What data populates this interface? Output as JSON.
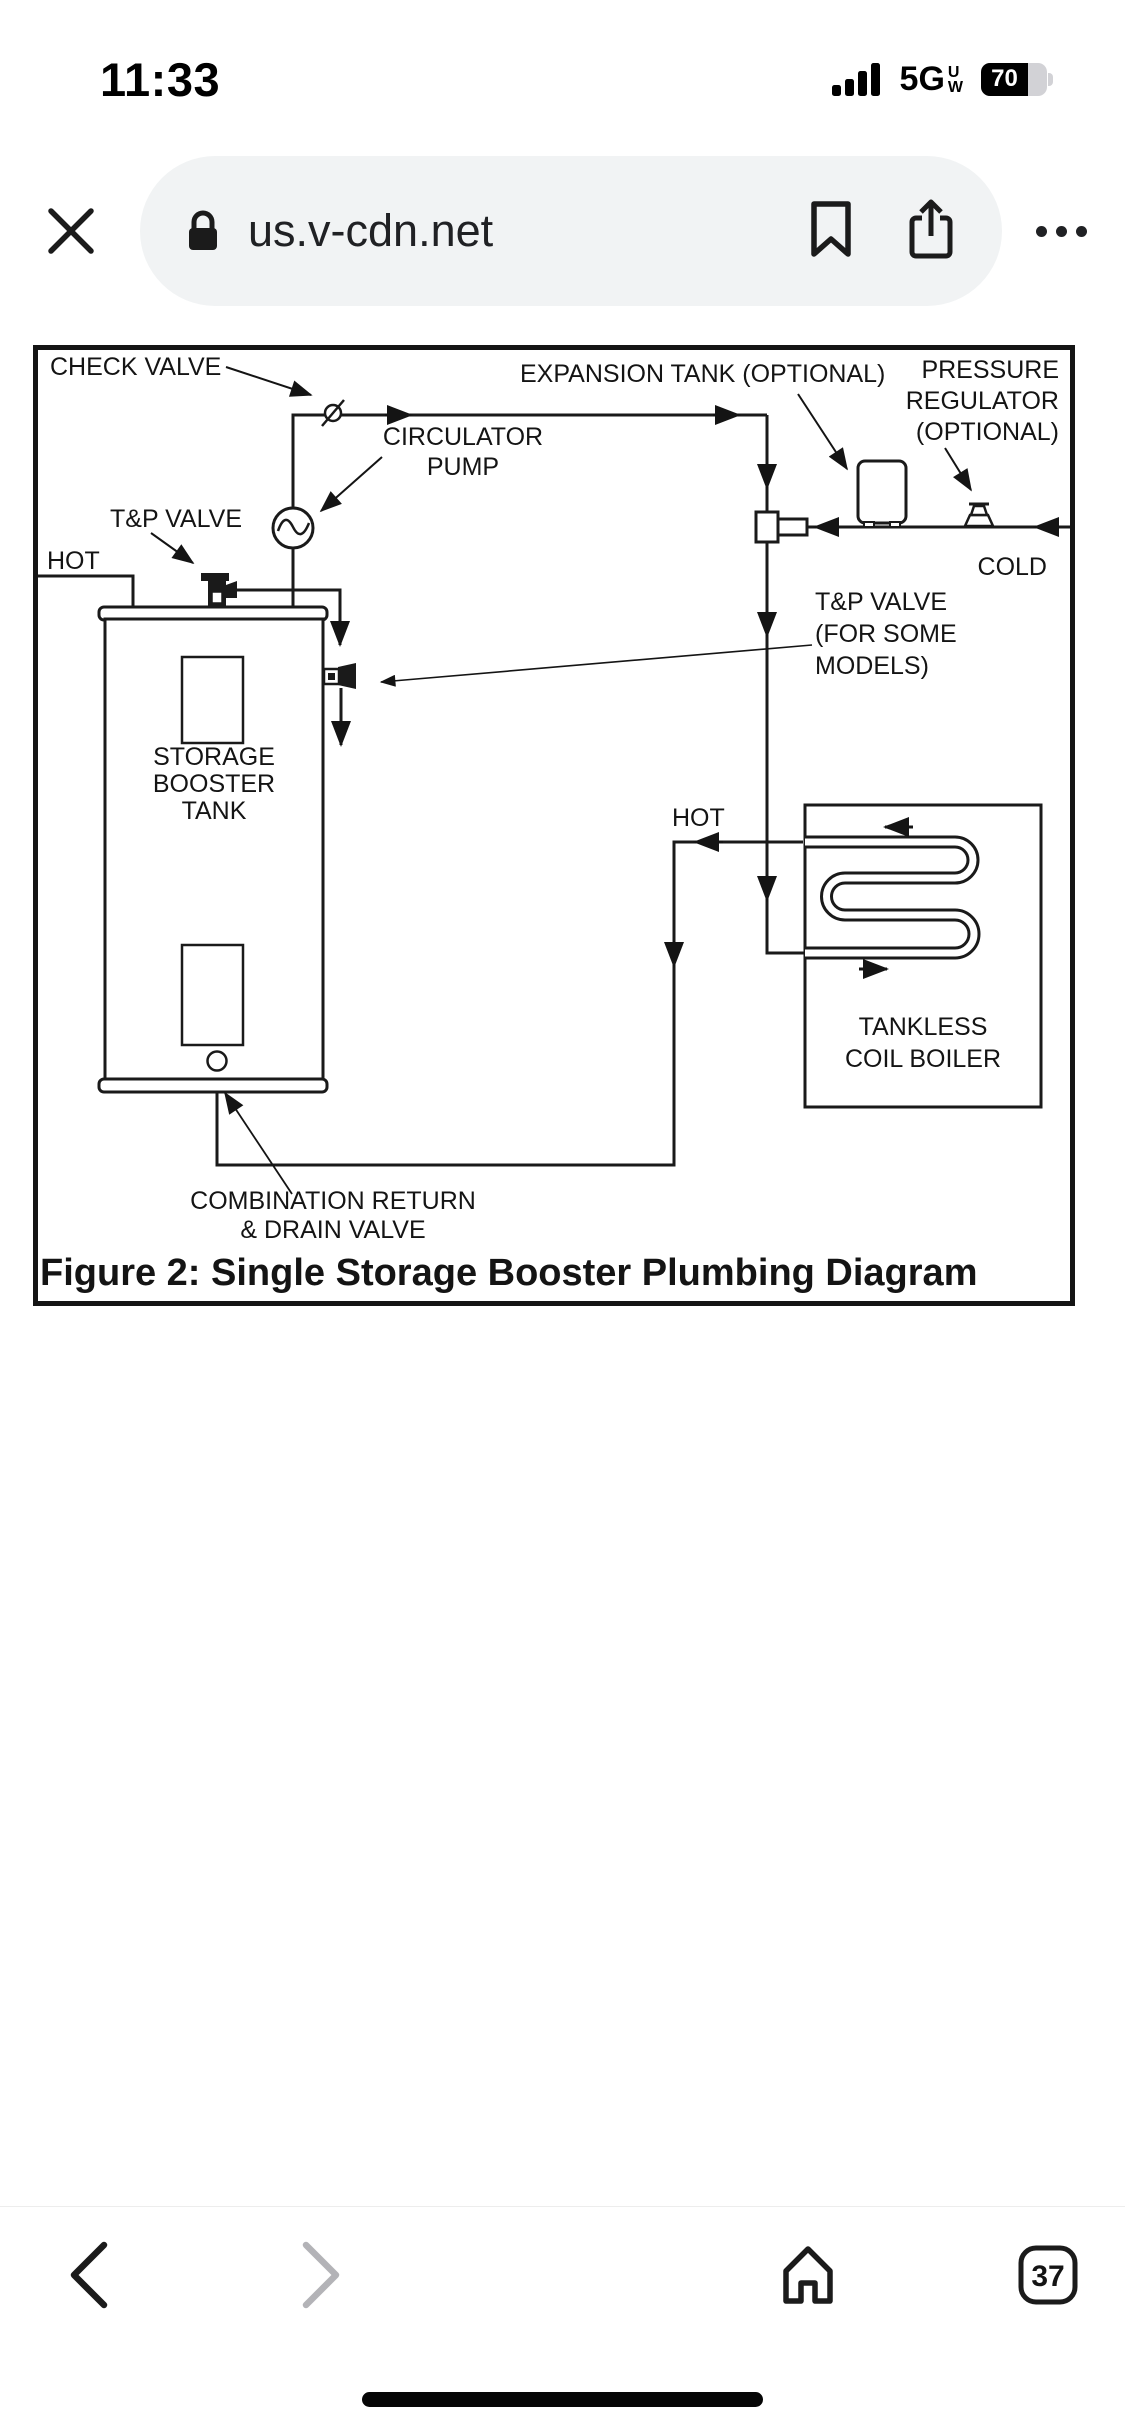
{
  "status_bar": {
    "time": "11:33",
    "signal_icon": "signal-bars-4",
    "network": "5G",
    "network_sub_top": "U",
    "network_sub_bottom": "W",
    "battery_percent": "70"
  },
  "url_bar": {
    "close_icon": "close-x",
    "lock_icon": "padlock",
    "url": "us.v-cdn.net",
    "bookmark_icon": "bookmark",
    "share_icon": "share-box-arrow",
    "more_icon": "three-dots"
  },
  "diagram": {
    "caption": "Figure 2:  Single Storage Booster Plumbing Diagram",
    "labels": {
      "check_valve": "CHECK VALVE",
      "expansion_tank": "EXPANSION TANK (OPTIONAL)",
      "pressure_regulator": [
        "PRESSURE",
        "REGULATOR",
        "(OPTIONAL)"
      ],
      "circulator_pump": [
        "CIRCULATOR",
        "PUMP"
      ],
      "tp_valve": "T&P VALVE",
      "hot_left": "HOT",
      "cold": "COLD",
      "tp_valve_some_models": [
        "T&P VALVE",
        "(FOR SOME",
        "MODELS)"
      ],
      "storage_booster_tank": [
        "STORAGE",
        "BOOSTER",
        "TANK"
      ],
      "hot_boiler": "HOT",
      "tankless_coil_boiler": [
        "TANKLESS",
        "COIL BOILER"
      ],
      "combination_return": [
        "COMBINATION RETURN",
        "& DRAIN VALVE"
      ]
    }
  },
  "toolbar": {
    "back_icon": "chevron-left",
    "forward_icon": "chevron-right",
    "home_icon": "home",
    "tab_count": "37"
  },
  "colors": {
    "line": "#1a1a1a",
    "pill_bg": "#f1f3f4",
    "disabled_chevron": "#b3b3b7",
    "battery_track": "#d2d2d6"
  }
}
